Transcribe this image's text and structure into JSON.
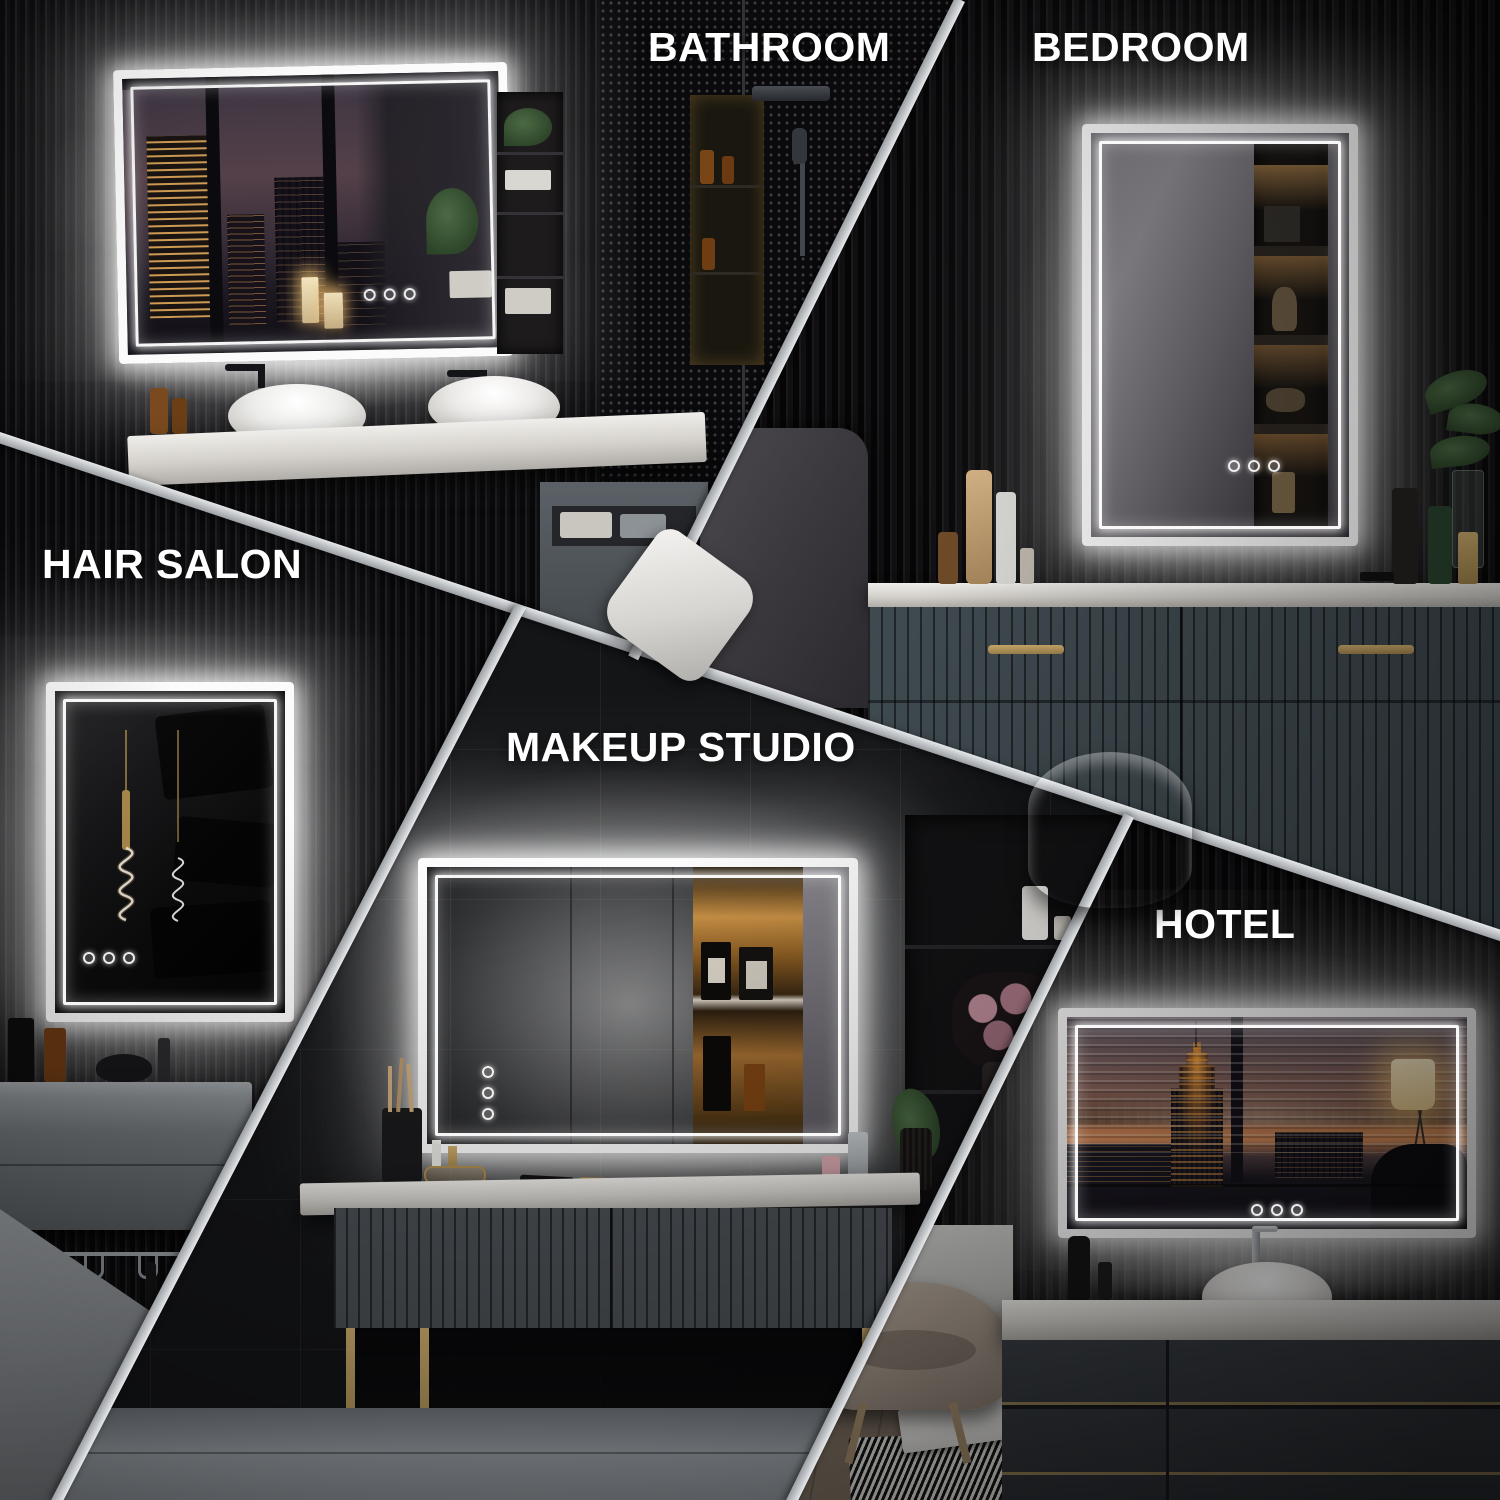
{
  "title": "LED mirror multi-scene collage",
  "sections": {
    "bathroom": {
      "label": "BATHROOM"
    },
    "bedroom": {
      "label": "BEDROOM"
    },
    "hair_salon": {
      "label": "HAIR SALON"
    },
    "makeup_studio": {
      "label": "MAKEUP STUDIO"
    },
    "hotel": {
      "label": "HOTEL"
    }
  },
  "colors": {
    "label_text": "#ffffff",
    "divider": "#c6c9cb",
    "led_glow": "#ffffff",
    "wall_dark": "#0c0c0e",
    "counter_white": "#e8e6e2",
    "sunset_orange": "#d98d5a",
    "warm_shelf_glow": "#c89045"
  },
  "mirror_touch_buttons_count": 3
}
